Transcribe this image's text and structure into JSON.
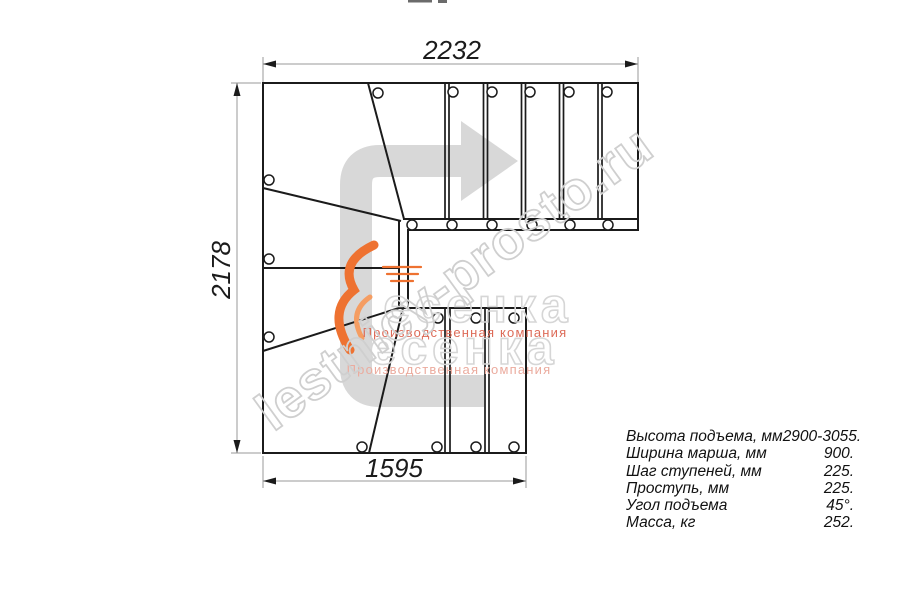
{
  "drawing": {
    "type": "staircase-floor-plan",
    "description": "L-shaped (90 degree turn) staircase top view with winder steps"
  },
  "dimensions": {
    "top": "2232",
    "left": "2178",
    "bottom": "1595"
  },
  "specs": {
    "rows": [
      {
        "label": "Высота подъема, мм",
        "value": "2900-3055."
      },
      {
        "label": "Ширина марша, мм",
        "value": "900."
      },
      {
        "label": "Шаг ступеней, мм",
        "value": "225."
      },
      {
        "label": "Проступь, мм",
        "value": "225."
      },
      {
        "label": "Угол подъема",
        "value": "45°."
      },
      {
        "label": "Масса, кг",
        "value": "252."
      }
    ]
  },
  "watermarks": {
    "diagonal": "lestnicy-prosto.ru",
    "brand_large": "есенка",
    "brand_subtitle": "Производственная компания"
  },
  "colors": {
    "plan_line": "#1b1b1b",
    "dimension_line": "#999999",
    "direction_arrow": "#d8d8d8",
    "watermark_outline": "#cfcfcf",
    "brand_red": "#dd6b58",
    "brand_red_light": "#ebab9e",
    "flame_orange": "#ee7231"
  }
}
